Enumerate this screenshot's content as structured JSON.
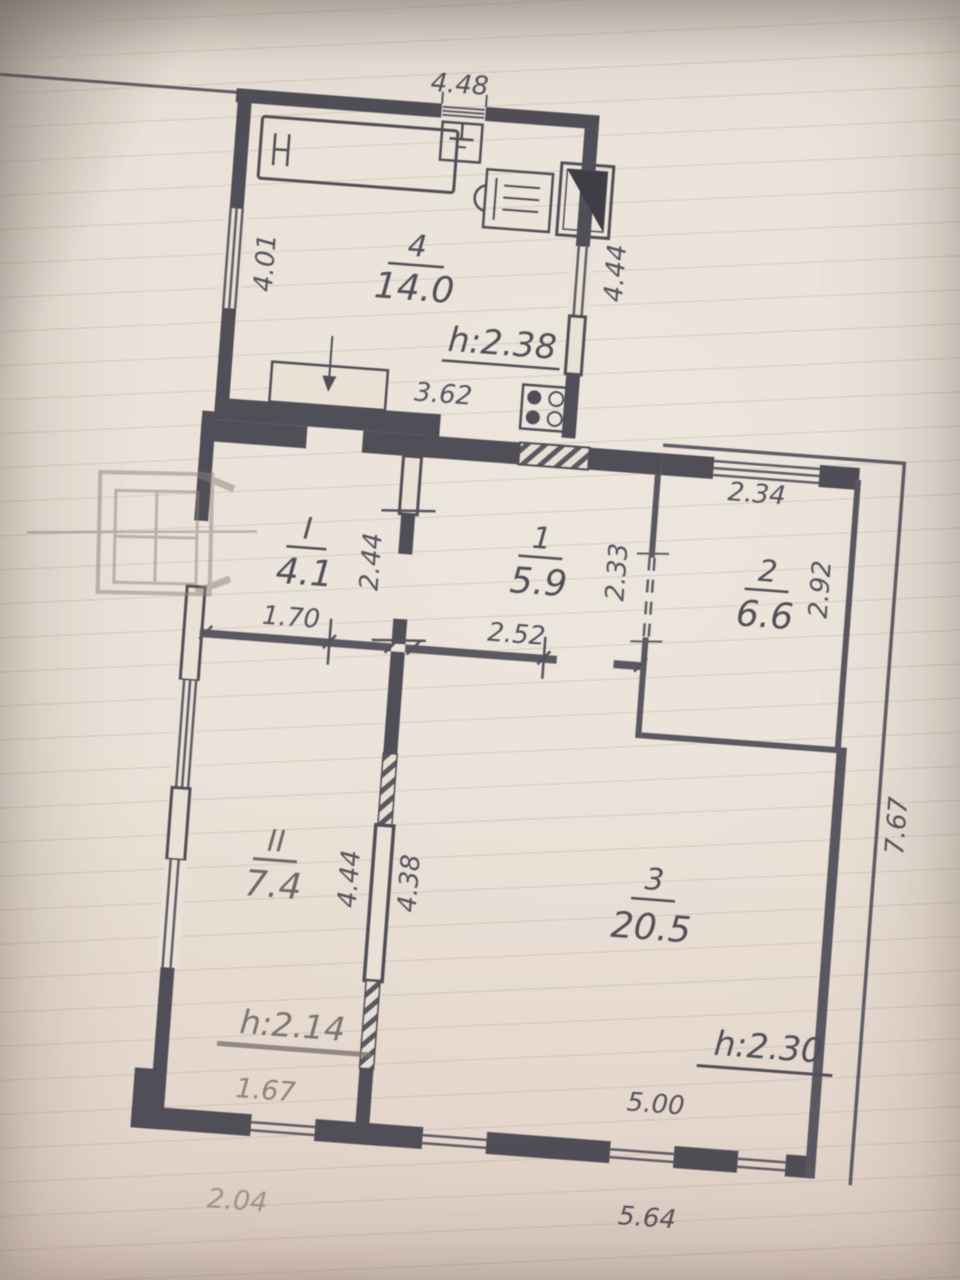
{
  "document": {
    "kind": "floor-plan-photo",
    "ink_color": "#504e57",
    "pencil_color": "#8b847d",
    "paper_color": "#e8dfd4"
  },
  "rooms": [
    {
      "number": "4",
      "area": "14.0"
    },
    {
      "number": "I",
      "area": "4.1"
    },
    {
      "number": "1",
      "area": "5.9"
    },
    {
      "number": "2",
      "area": "6.6"
    },
    {
      "number": "II",
      "area": "7.4"
    },
    {
      "number": "3",
      "area": "20.5"
    }
  ],
  "heights": {
    "room4": "h:2.38",
    "roomII": "h:2.14",
    "room3": "h:2.30"
  },
  "dimensions": {
    "top_width": "4.48",
    "room4_left": "4.01",
    "room4_right": "4.44",
    "room4_inner": "3.62",
    "hall_wall": "2.44",
    "hall_width": "1.70",
    "room1_width": "2.52",
    "room1_opening": "2.33",
    "room2_top": "2.34",
    "room2_side": "2.92",
    "roomII_wall": "4.44",
    "room3_wall": "4.38",
    "room3_bottom": "5.00",
    "right_side": "7.67",
    "roomII_bottom": "1.67",
    "bottom_left": "2.04",
    "bottom_right": "5.64"
  },
  "fixtures": {
    "bed": "bed",
    "sink_top": "sink",
    "heater": "gas-heater",
    "sink_unit": "sink-unit",
    "stove": "stove-4-burner",
    "vent": "vent-shaft",
    "porch": "porch-sketch"
  }
}
